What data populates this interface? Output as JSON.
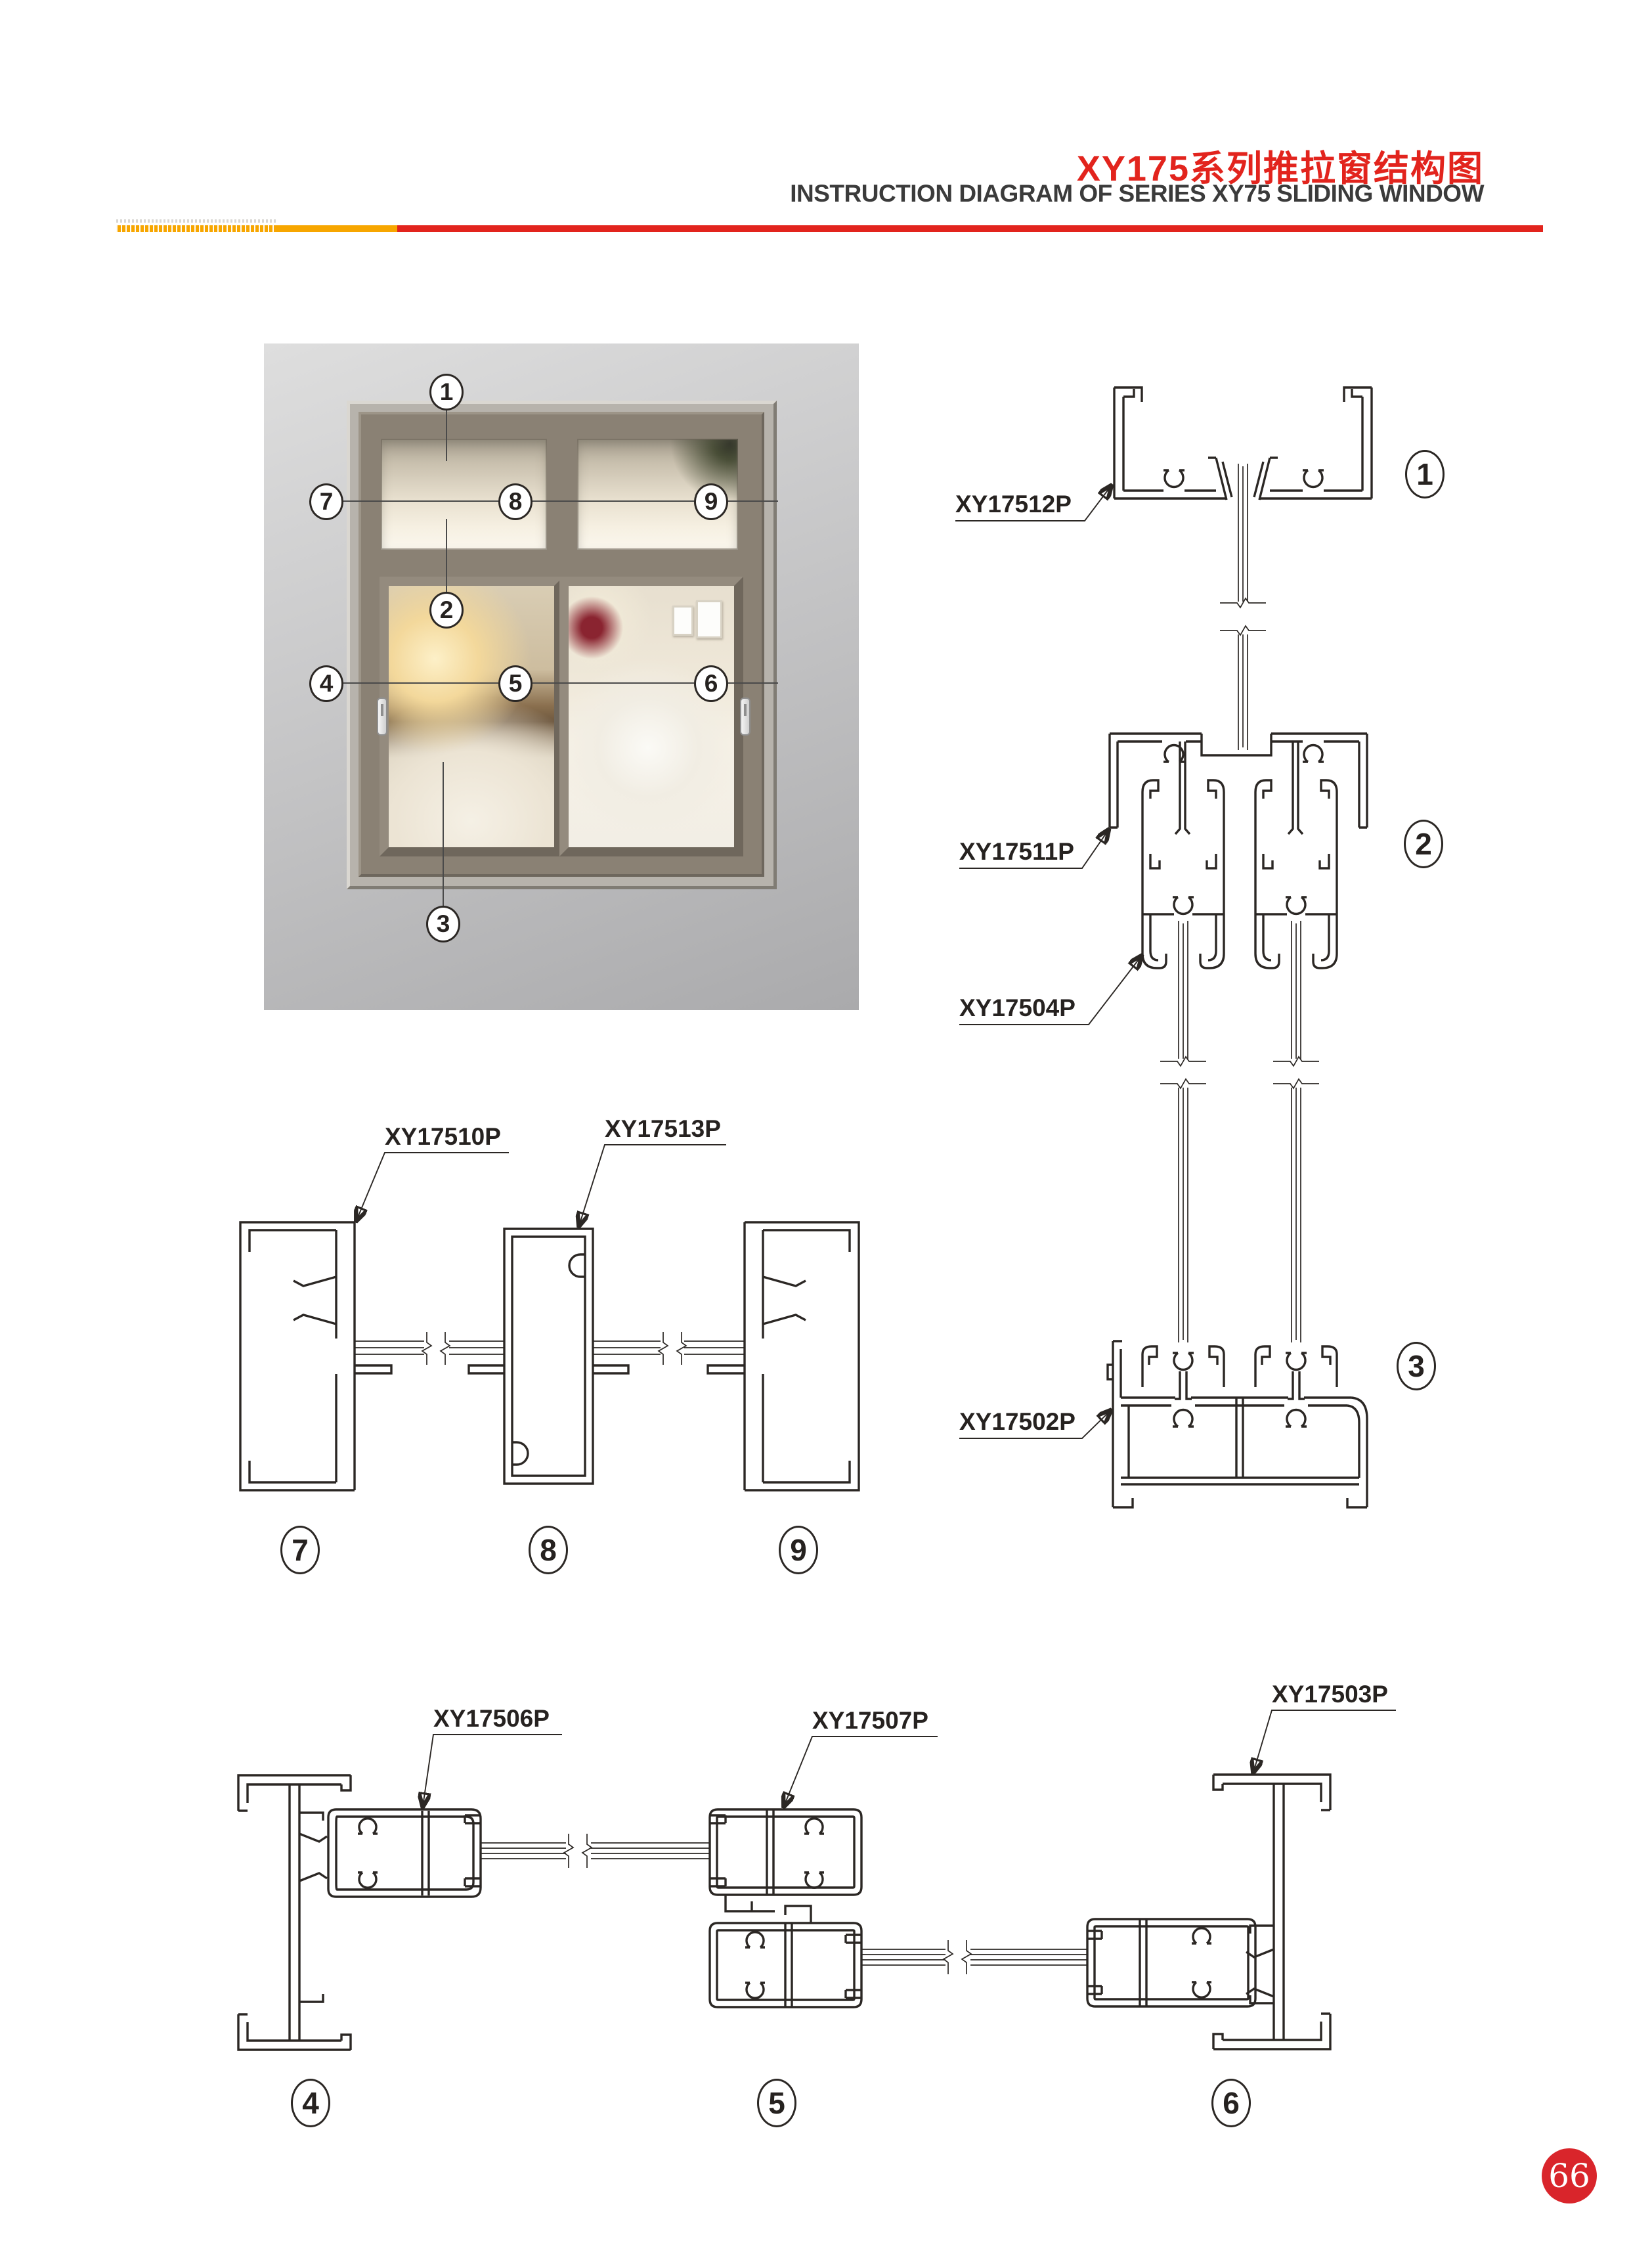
{
  "header": {
    "title_zh": "XY175系列推拉窗结构图",
    "title_en": "INSTRUCTION DIAGRAM OF SERIES XY75 SLIDING WINDOW"
  },
  "window": {
    "callouts": [
      "1",
      "2",
      "3",
      "4",
      "5",
      "6",
      "7",
      "8",
      "9"
    ]
  },
  "sections": {
    "right_column": {
      "circles": [
        "1",
        "2",
        "3"
      ],
      "labels": [
        "XY17512P",
        "XY17511P",
        "XY17504P",
        "XY17502P"
      ]
    },
    "middle_row": {
      "circles": [
        "7",
        "8",
        "9"
      ],
      "labels": [
        "XY17510P",
        "XY17513P"
      ]
    },
    "bottom_row": {
      "circles": [
        "4",
        "5",
        "6"
      ],
      "labels": [
        "XY17506P",
        "XY17507P",
        "XY17503P"
      ]
    }
  },
  "page": {
    "number": "66"
  },
  "colors": {
    "title_red": "#E2241D",
    "bar_yellow": "#F7A600",
    "bar_red": "#E2241D",
    "badge_red": "#D9252B",
    "line": "#2B2724"
  }
}
